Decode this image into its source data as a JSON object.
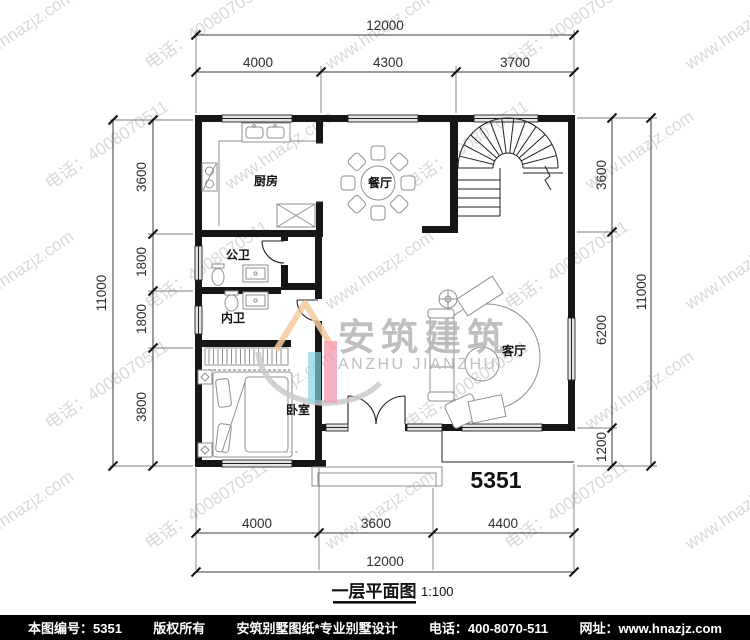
{
  "page": {
    "bg": "#ffffff",
    "footer_bg": "#000000"
  },
  "plan": {
    "number": "5351",
    "title": "一层平面图",
    "scale": "1:100"
  },
  "rooms": {
    "kitchen": "厨房",
    "dining": "餐厅",
    "public_bath": "公卫",
    "private_bath": "内卫",
    "bedroom": "卧室",
    "living": "客厅"
  },
  "dims": {
    "top": {
      "total": "12000",
      "segments": [
        "4000",
        "4300",
        "3700"
      ]
    },
    "bottom": {
      "total": "12000",
      "segments": [
        "4000",
        "3600",
        "4400"
      ]
    },
    "left": {
      "total": "11000",
      "segments": [
        "3600",
        "1800",
        "1800",
        "3800"
      ]
    },
    "right": {
      "total": "11000",
      "segments": [
        "3600",
        "6200",
        "1200"
      ]
    }
  },
  "logo": {
    "cn": "安筑建筑",
    "en": "ANZHU  JIANZHU",
    "swoosh_color": "#cbcbcb",
    "roof_color": "#f6c89e",
    "pink_color": "#f08fa6",
    "cyan_color": "#85d5df",
    "text_color": "#b4b4b4"
  },
  "watermark": {
    "lines": [
      "www.hnazjz.com",
      "电话：4008070511"
    ],
    "color": "#bfbfbf",
    "angle": -34
  },
  "footer": {
    "items": [
      "本图编号：5351",
      "版权所有",
      "安筑别墅图纸*专业别墅设计",
      "电话：400-8070-511",
      "网址：www.hnazjz.com"
    ]
  }
}
